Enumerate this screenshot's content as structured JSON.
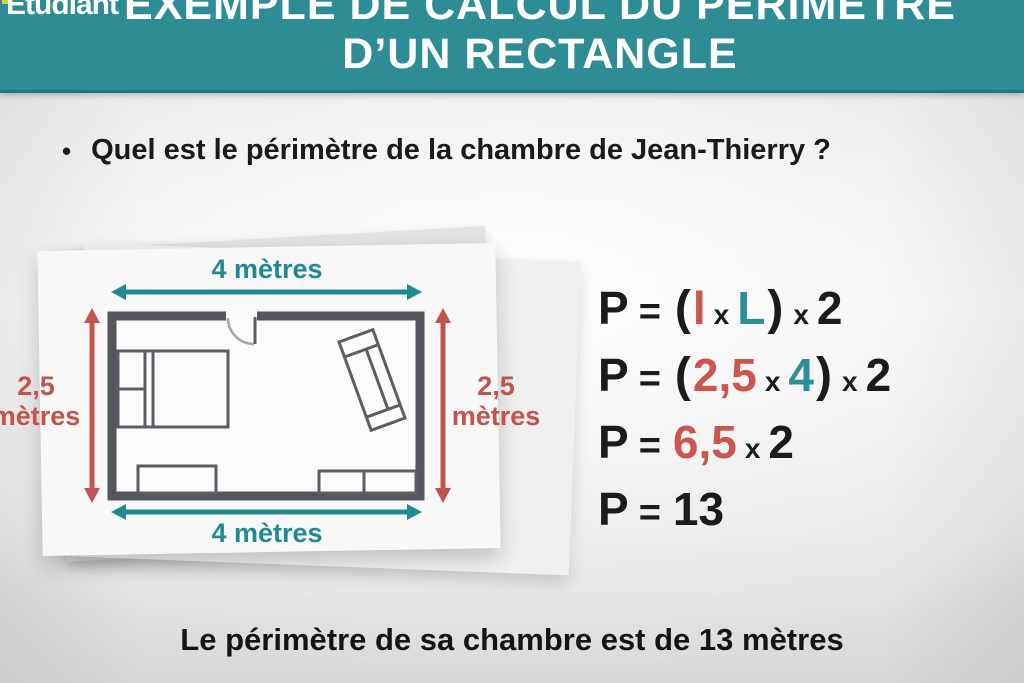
{
  "header": {
    "logo_text": "Etudiant",
    "title_line1": "EXEMPLE DE CALCUL DU PÉRIMÈTRE",
    "title_line2": "D’UN RECTANGLE"
  },
  "question": {
    "bullet": "•",
    "text": "Quel est le périmètre de la chambre de Jean-Thierry ?"
  },
  "floor_plan": {
    "top_dimension": "4 mètres",
    "bottom_dimension": "4 mètres",
    "left_dimension_value": "2,5",
    "left_dimension_unit": "mètres",
    "right_dimension_value": "2,5",
    "right_dimension_unit": "mètres",
    "width_label_meters": "4",
    "height_label_meters": "2,5"
  },
  "formulas": {
    "lines": [
      {
        "tokens": [
          {
            "t": "P",
            "c": "black",
            "s": "big"
          },
          {
            "t": "=",
            "c": "black",
            "s": "eq"
          },
          {
            "t": "(",
            "c": "black",
            "s": "paren"
          },
          {
            "t": "l",
            "c": "red",
            "s": "big"
          },
          {
            "t": "x",
            "c": "black",
            "s": "small"
          },
          {
            "t": "L",
            "c": "teal",
            "s": "big"
          },
          {
            "t": ")",
            "c": "black",
            "s": "paren"
          },
          {
            "t": "x",
            "c": "black",
            "s": "small"
          },
          {
            "t": "2",
            "c": "black",
            "s": "big"
          }
        ]
      },
      {
        "tokens": [
          {
            "t": "P",
            "c": "black",
            "s": "big"
          },
          {
            "t": "=",
            "c": "black",
            "s": "eq"
          },
          {
            "t": "(",
            "c": "black",
            "s": "paren"
          },
          {
            "t": "2,5",
            "c": "red",
            "s": "big"
          },
          {
            "t": "x",
            "c": "black",
            "s": "small"
          },
          {
            "t": "4",
            "c": "teal",
            "s": "big"
          },
          {
            "t": ")",
            "c": "black",
            "s": "paren"
          },
          {
            "t": "x",
            "c": "black",
            "s": "small"
          },
          {
            "t": "2",
            "c": "black",
            "s": "big"
          }
        ]
      },
      {
        "tokens": [
          {
            "t": "P",
            "c": "black",
            "s": "big"
          },
          {
            "t": "=",
            "c": "black",
            "s": "eq"
          },
          {
            "t": "6,5",
            "c": "red",
            "s": "big"
          },
          {
            "t": "x",
            "c": "black",
            "s": "small"
          },
          {
            "t": "2",
            "c": "black",
            "s": "big"
          }
        ]
      },
      {
        "tokens": [
          {
            "t": "P",
            "c": "black",
            "s": "big"
          },
          {
            "t": "=",
            "c": "black",
            "s": "eq"
          },
          {
            "t": "13",
            "c": "black",
            "s": "big"
          }
        ]
      }
    ]
  },
  "conclusion": "Le périmètre de sa chambre est de 13 mètres",
  "colors": {
    "header_teal": "#2e8c95",
    "dimension_teal": "#1f8a92",
    "dimension_red": "#c2544d",
    "formula_red": "#cb564e",
    "formula_teal": "#2d8d98",
    "wall_gray": "#55555c",
    "text_black": "#1b1b1b"
  }
}
